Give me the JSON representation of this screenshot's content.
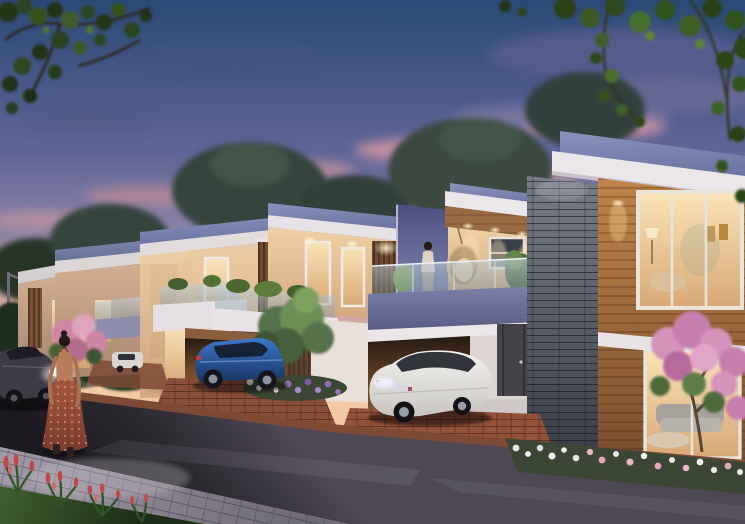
{
  "scene": {
    "description": "dusk-architectural-render-villa-row-street",
    "width": 745,
    "height": 524
  },
  "palette": {
    "sky_top": "#2b4976",
    "sky_upper": "#5f6597",
    "sky_mid": "#8f84a6",
    "sky_lower": "#c89d9c",
    "sky_horizon": "#f2c9a4",
    "horizon_glow": "#f6cfa2",
    "cloud_purple": "#575d8f",
    "cloud_pink": "#d296a3",
    "roof_slab_light": "#8a93bd",
    "roof_slab_dark": "#6d76a2",
    "fascia_white": "#eae6ea",
    "wall_cream_light": "#f0d0a6",
    "wall_cream_shade": "#d2a77d",
    "wall_distant": "#d4b094",
    "wood_plank_light": "#c08449",
    "wood_plank_dark": "#7a4e2d",
    "wood_slat": "#6e4c31",
    "stone_light": "#787d88",
    "stone_dark": "#3a3e46",
    "parapet_light": "#7d80a8",
    "parapet_dark": "#595c84",
    "tower_blue": "#4b5080",
    "glass_tint": "#c6d4da",
    "window_glow_bright": "#fae4b8",
    "window_glow_deep": "#d8a876",
    "door_dark": "#46424a",
    "carport_glow": "#8a5e3e",
    "road_light": "#4d4854",
    "road_dark": "#1d1b21",
    "sidewalk_light": "#a19aa8",
    "sidewalk_dark": "#6f6a78",
    "curb_brick": "#7e4a36",
    "driveway_brick": "#95523a",
    "grass_light": "#3f6132",
    "grass_dark": "#1c2e15",
    "tree_canopy": "#36443c",
    "foliage_dark": "#223618",
    "foliage_lit": "#47702e",
    "flower_pink": "#d78fae",
    "flower_purple": "#8d6bb5",
    "flower_white": "#ece6ec",
    "flower_red": "#c24848",
    "car_white": "#f4f3f1",
    "car_blue_light": "#3f78cc",
    "car_blue_dark": "#173461",
    "car_dark_gray": "#3e3b46",
    "headlight": "#ffffff",
    "taillight_glow": "#eef2ff",
    "dress_light": "#a85a40",
    "dress_dark": "#7c3a2c",
    "skin": "#b97d5e",
    "hair": "#241a16",
    "egg_chair": "#d8b88a"
  },
  "objects": {
    "villas": [
      "villa-far",
      "villa-4",
      "villa-3",
      "villa-2",
      "villa-balcony",
      "villa-front"
    ],
    "vehicles": [
      "dark-sedan-driving",
      "distant-white-car",
      "blue-hatchback",
      "white-sedan"
    ],
    "figures": [
      "woman-walking",
      "woman-on-balcony"
    ],
    "landscape": [
      "dusk-sky",
      "clouds",
      "background-trees",
      "overhanging-foliage",
      "street-road",
      "sidewalk",
      "front-lawn",
      "flower-beds",
      "pink-flowering-tree",
      "hanging-egg-chair"
    ]
  }
}
